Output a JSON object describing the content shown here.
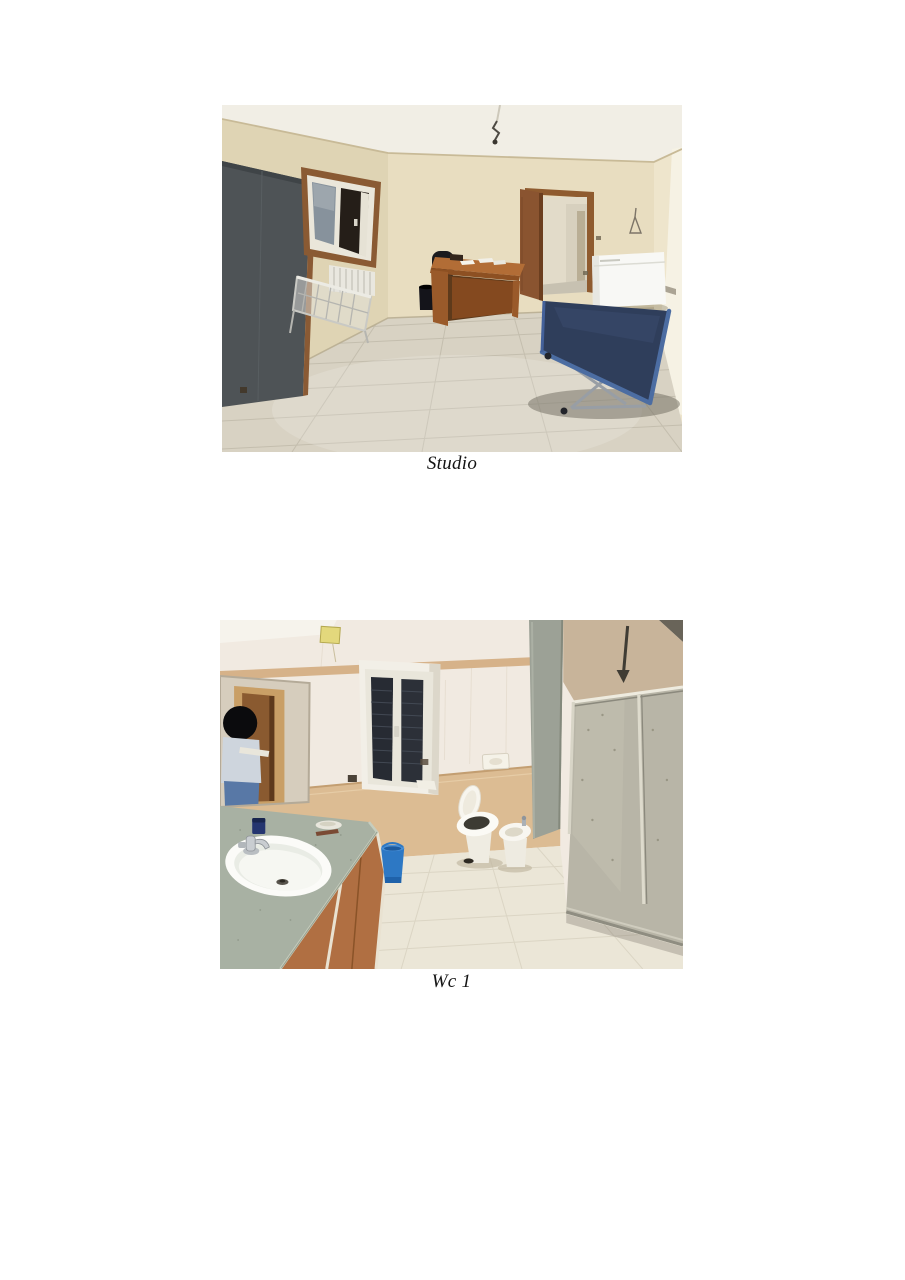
{
  "page": {
    "background_color": "#ffffff"
  },
  "photos": [
    {
      "id": "studio",
      "caption": "Studio"
    },
    {
      "id": "wc-1",
      "caption": "Wc 1"
    }
  ]
}
